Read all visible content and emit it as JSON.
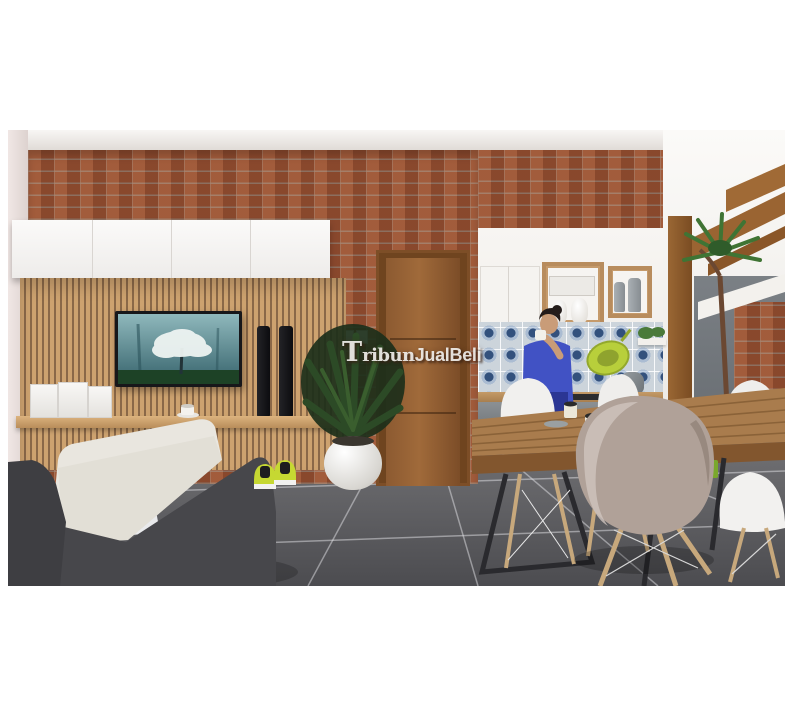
{
  "page": {
    "background": "#ffffff"
  },
  "watermark": {
    "t": "T",
    "ribun": "ribun",
    "part2": "JualBeli",
    "full_text": "TribunJualBeli"
  },
  "scene": {
    "type": "interior-3d-render",
    "areas": [
      "living-room",
      "kitchen",
      "dining-area",
      "courtyard"
    ],
    "colors": {
      "brick": "#9b5233",
      "wood_slats": "#c89a6a",
      "cabinet_white": "#f4f2ef",
      "floor_tile": "#55565a",
      "sofa_dark": "#46464a",
      "sofa_cushion": "#e9e6df",
      "door_wood": "#8a5830",
      "table_wood": "#a97c4d",
      "chair_taupe": "#b0a198",
      "accent_lime": "#c3d434",
      "person_shirt": "#4152c4",
      "tile_navy": "#33517d",
      "foliage": "#2c4a26",
      "tv_screen_teal": "#4a7a80"
    }
  }
}
